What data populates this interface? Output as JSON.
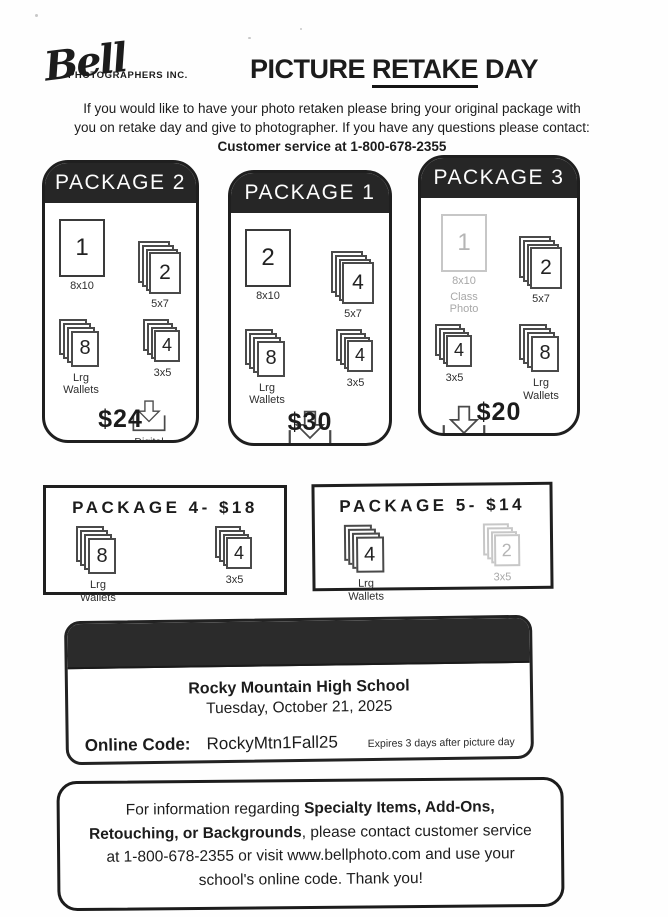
{
  "logo": {
    "script": "Bell",
    "subtext": "PHOTOGRAPHERS INC."
  },
  "title": {
    "pre": "PICTURE ",
    "underlined": "RETAKE",
    "post": " DAY"
  },
  "intro": {
    "segments": [
      {
        "text": "If you would like to have your photo retaken please bring your original package with you on retake day and give to photographer. If you have any questions please contact: ",
        "bold": false
      },
      {
        "text": "Customer service at 1-800-678-2355",
        "bold": true
      }
    ]
  },
  "cards": [
    {
      "title": "PACKAGE 2",
      "price": "$24",
      "rows": [
        {
          "items": [
            {
              "type": "photo-lg",
              "count": "1",
              "label": "8x10"
            },
            {
              "type": "stack-57",
              "count": "2",
              "label": "5x7"
            }
          ]
        },
        {
          "items": [
            {
              "type": "stack-wallet",
              "count": "8",
              "label": "Lrg Wallets"
            },
            {
              "type": "stack-35",
              "count": "4",
              "label": "3x5"
            }
          ]
        },
        {
          "align": "right",
          "items": [
            {
              "type": "download",
              "label": "Digital Download",
              "size": "sm"
            }
          ]
        }
      ]
    },
    {
      "title": "PACKAGE 1",
      "price": "$30",
      "rows": [
        {
          "items": [
            {
              "type": "photo-lg",
              "count": "2",
              "label": "8x10"
            },
            {
              "type": "stack-57",
              "count": "4",
              "label": "5x7"
            }
          ]
        },
        {
          "items": [
            {
              "type": "stack-wallet",
              "count": "8",
              "label": "Lrg Wallets"
            },
            {
              "type": "stack-35",
              "count": "4",
              "label": "3x5"
            }
          ]
        },
        {
          "align": "center",
          "items": [
            {
              "type": "download",
              "label": "Digital Download"
            }
          ]
        }
      ]
    },
    {
      "title": "PACKAGE 3",
      "price": "$20",
      "rows": [
        {
          "items": [
            {
              "type": "photo-lg",
              "count": "1",
              "label": "8x10",
              "sub": "Class Photo",
              "faded": true
            },
            {
              "type": "stack-57",
              "count": "2",
              "label": "5x7"
            }
          ]
        },
        {
          "items": [
            {
              "type": "stack-35",
              "count": "4",
              "label": "3x5"
            },
            {
              "type": "stack-wallet",
              "count": "8",
              "label": "Lrg Wallets"
            }
          ]
        },
        {
          "align": "left",
          "items": [
            {
              "type": "download",
              "label": "Digital Download"
            }
          ]
        }
      ]
    }
  ],
  "mini_packages": [
    {
      "title": "PACKAGE 4- $18",
      "items": [
        {
          "type": "stack-wallet",
          "count": "8",
          "label": "Lrg Wallets"
        },
        {
          "type": "stack-35",
          "count": "4",
          "label": "3x5"
        }
      ]
    },
    {
      "title": "PACKAGE 5- $14",
      "items": [
        {
          "type": "stack-wallet",
          "count": "4",
          "label": "Lrg Wallets"
        },
        {
          "type": "stack-35",
          "count": "2",
          "label": "3x5",
          "faded": true
        }
      ]
    }
  ],
  "school": {
    "name": "Rocky Mountain High School",
    "date": "Tuesday, October 21, 2025",
    "code_label": "Online Code:",
    "code": "RockyMtn1Fall25",
    "expires": "Expires 3 days after picture day"
  },
  "notice": {
    "segments": [
      {
        "text": "For information regarding ",
        "bold": false
      },
      {
        "text": "Specialty Items, Add-Ons, Retouching, or Backgrounds",
        "bold": true
      },
      {
        "text": ", please contact customer service at 1-800-678-2355 or visit www.bellphoto.com and use your school's online code. Thank you!",
        "bold": false
      }
    ]
  },
  "colors": {
    "ink": "#1c1c1c",
    "header_bar": "#262626",
    "faded": "#b8b8b8"
  }
}
